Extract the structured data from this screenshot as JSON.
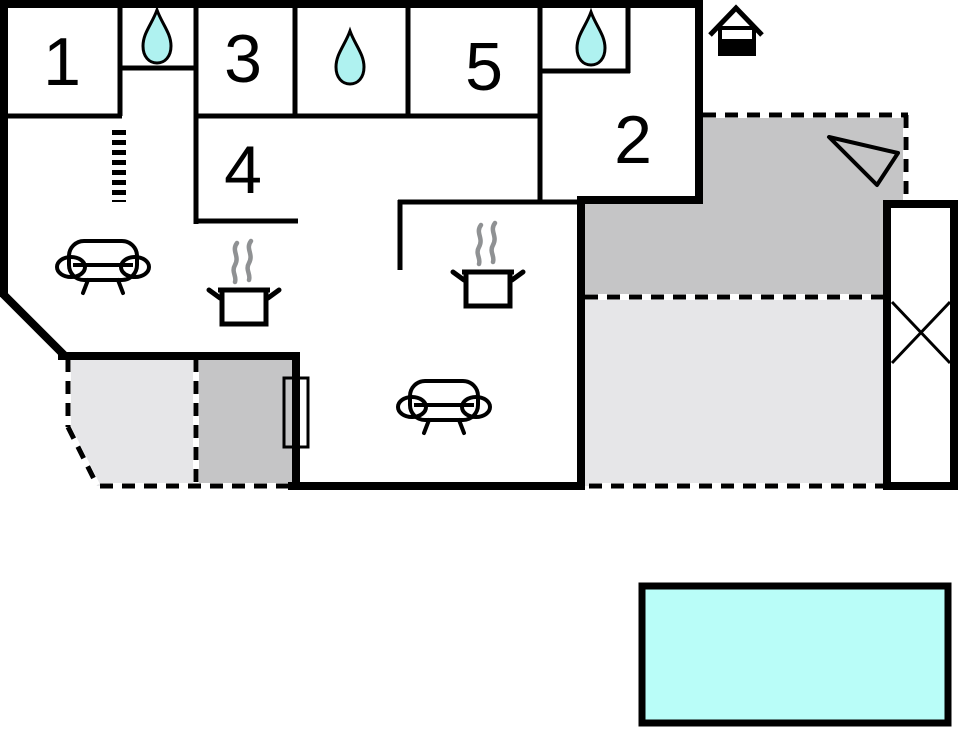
{
  "page": {
    "title": "Holiday home floor plan"
  },
  "rooms": [
    {
      "id": "room-1",
      "label": "1"
    },
    {
      "id": "room-3",
      "label": "3"
    },
    {
      "id": "room-4",
      "label": "4"
    },
    {
      "id": "room-5",
      "label": "5"
    },
    {
      "id": "room-2",
      "label": "2"
    }
  ],
  "colors": {
    "wall": "#000000",
    "terrace_dark": "#c5c5c6",
    "terrace_light": "#e6e6e8",
    "water_drop": "#aff2f0",
    "pool": "#b9fdf8",
    "steam": "#8f9193"
  },
  "icons": {
    "water-drop-icon": "💧",
    "sofa-icon": "🛋",
    "cooking-pot-icon": "🍲",
    "well-icon": "⌂",
    "ladder-icon": "☰",
    "annex-cross-icon": "✕",
    "direction-arrow-icon": "➤"
  }
}
